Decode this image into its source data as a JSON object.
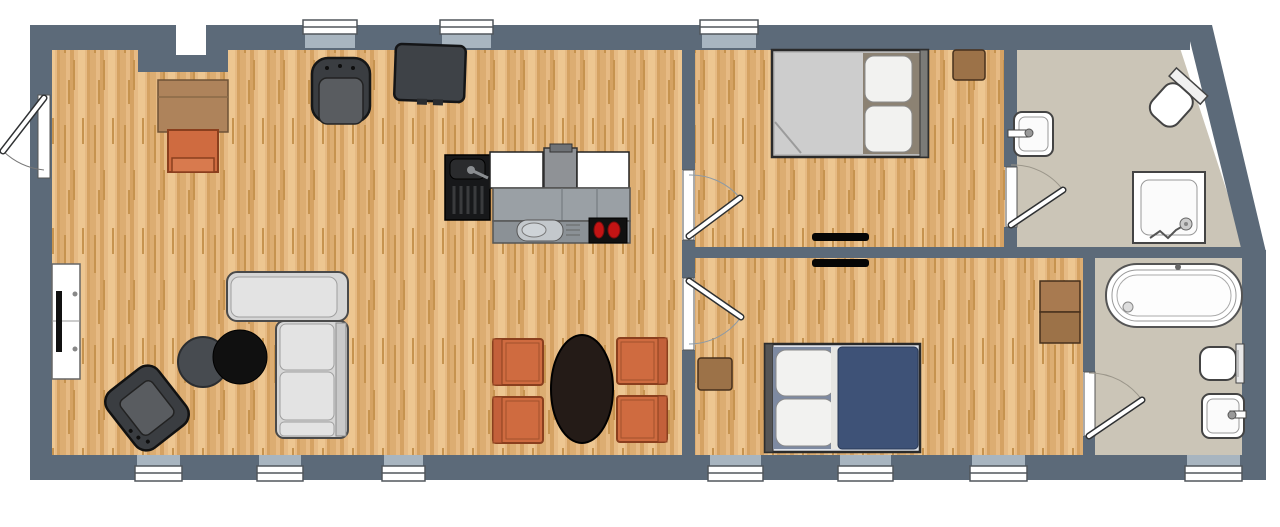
{
  "meta": {
    "title": "Apartment floor plan",
    "view": "top-down 2D plan"
  },
  "palette": {
    "wall": "#5c6a79",
    "window_recess": "#a8b5c0",
    "glass_white": "#ffffff",
    "wood_a": "#e6ba84",
    "wood_b": "#dcad72",
    "wood_c": "#d5a263",
    "wood_d": "#edc691",
    "wood_streak": "#c6934f",
    "bath_floor": "#cbc5b7",
    "outline_dark": "#2f3133",
    "sofa_base": "#d6d6d6",
    "sofa_cushion": "#e3e3e3",
    "chair_orange": "#cf6b40",
    "chair_orange_border": "#8a3f1e",
    "furniture_dark": "#3a3d41",
    "furniture_dark_inner": "#595c60",
    "table_black": "#101010",
    "table_gray": "#474b50",
    "dining_table": "#241b17",
    "cabinet_brown": "#ae835b",
    "cabinet_brown_border": "#6e5236",
    "nightstand_brown": "#9c7248",
    "nightstand_border": "#46301c",
    "bed_blanket_blue": "#3e5277",
    "bed_pillowzone_blue": "#7e8aa1",
    "bed_mattress_gray": "#cdcdcd",
    "bed_pillowzone_taupe": "#8c8273",
    "pillow_white": "#f2f2f0",
    "fixture_stroke": "#444444",
    "counter_gray": "#9aa0a5",
    "kitchen_black": "#17181a",
    "burner_red": "#c31414",
    "vent_black": "#060606"
  },
  "openings": {
    "windows": 10,
    "exterior_doors": 1,
    "interior_doors": 4,
    "wall_vents": 2
  },
  "rooms": [
    {
      "id": "living-kitchen-dining",
      "floor": "wood",
      "furniture": [
        "desk",
        "desk-chair",
        "office-chair",
        "media-cabinet",
        "kitchen-block (sink unit, counters, hood, cooktop with 2 burners)",
        "sectional-sofa",
        "coffee-table-gray",
        "coffee-table-black",
        "armchair",
        "tv-sideboard",
        "oval-dining-table",
        "4 dining-chairs"
      ]
    },
    {
      "id": "bedroom-1",
      "floor": "wood",
      "furniture": [
        "double-bed",
        "nightstand"
      ]
    },
    {
      "id": "bathroom-1",
      "floor": "tile",
      "fixtures": [
        "wall-sink",
        "toilet",
        "shower"
      ]
    },
    {
      "id": "bedroom-2",
      "floor": "wood",
      "furniture": [
        "double-bed-blue",
        "nightstand",
        "dresser"
      ]
    },
    {
      "id": "bathroom-2",
      "floor": "tile",
      "fixtures": [
        "bathtub",
        "toilet",
        "sink"
      ]
    }
  ]
}
